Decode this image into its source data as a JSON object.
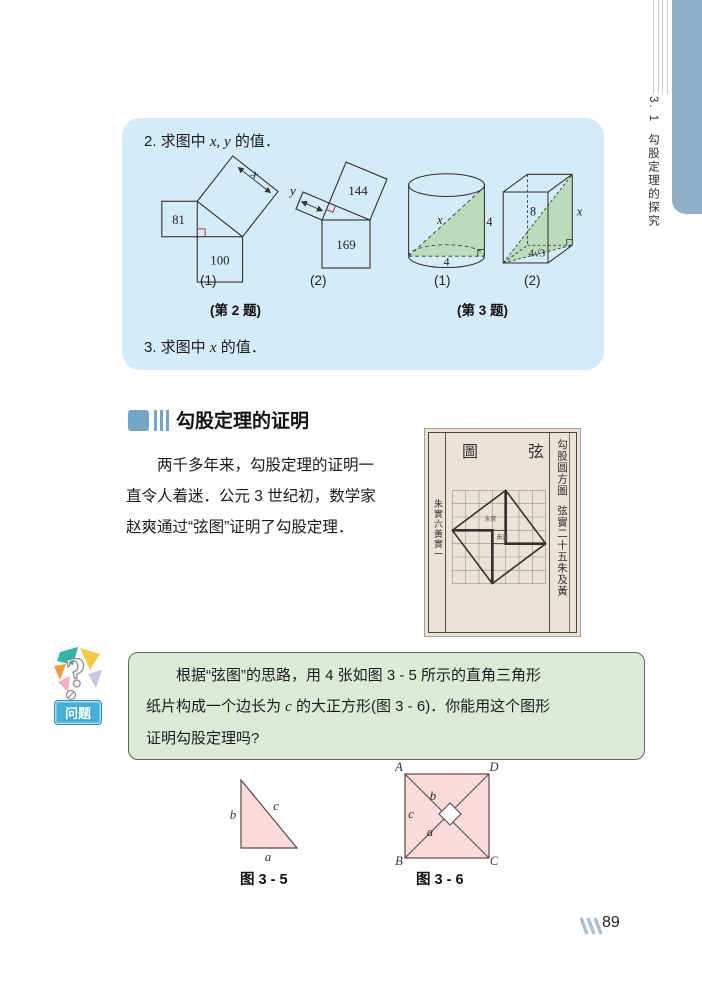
{
  "page": {
    "number": "89"
  },
  "sidebar": {
    "section_no": "3. 1",
    "title": "勾股定理的探究"
  },
  "exercise_box": {
    "problem2": {
      "prefix": "2. 求图中 ",
      "vars": "x, y",
      "suffix": " 的值．"
    },
    "problem3": {
      "prefix": "3. 求图中 ",
      "vars": "x",
      "suffix": " 的值．"
    },
    "figures": {
      "fig2_1": {
        "square_left": "81",
        "square_bottom": "100",
        "hyp_label": "x",
        "caption": "(1)"
      },
      "fig2_2": {
        "dim_label": "y",
        "square_tilted": "144",
        "square_bottom": "169",
        "caption": "(2)"
      },
      "fig3_1": {
        "hyp_label": "x",
        "side_label": "4",
        "bottom_label": "4",
        "caption": "(1)"
      },
      "fig3_2": {
        "diag_label": "8",
        "edge_label": "x",
        "bottom_label": "4√3",
        "caption": "(2)"
      },
      "label_q2": "(第 2 题)",
      "label_q3": "(第 3 题)"
    }
  },
  "section": {
    "title": "勾股定理的证明",
    "paragraph_lines": {
      "l1": "两千多年来，勾股定理的证明一",
      "l2": "直令人着迷．公元 3 世纪初，数学家",
      "l3": "赵爽通过“弦图”证明了勾股定理．"
    }
  },
  "ancient_figure": {
    "title_right": "弦",
    "title_left": "圖",
    "right_col_top": "勾股圆方圖",
    "right_col_bottom": "弦實二十五朱及黃",
    "left_col": "朱實六黃實一",
    "inner_label_1": "朱實",
    "inner_label_2": "黃實"
  },
  "question_box": {
    "label": "问题",
    "line1": "根据“弦图”的思路，用 4 张如图 3 - 5 所示的直角三角形",
    "line2_pre": "纸片构成一个边长为 ",
    "line2_var": "c",
    "line2_post": " 的大正方形(图 3 - 6)．你能用这个图形",
    "line3": "证明勾股定理吗?"
  },
  "figure35": {
    "b": "b",
    "c": "c",
    "a": "a",
    "caption": "图 3 - 5"
  },
  "figure36": {
    "A": "A",
    "D": "D",
    "B": "B",
    "C": "C",
    "b": "b",
    "c": "c",
    "a": "a",
    "caption": "图 3 - 6"
  },
  "colors": {
    "box_blue": "#d4ebf8",
    "tab_blue": "#8fb0ca",
    "box_green": "#dcebd6",
    "fig_green": "#b7dab2",
    "fig_pink": "#f9dbdb",
    "label_blue": "#45aed6",
    "marker_red": "#b03a36"
  }
}
